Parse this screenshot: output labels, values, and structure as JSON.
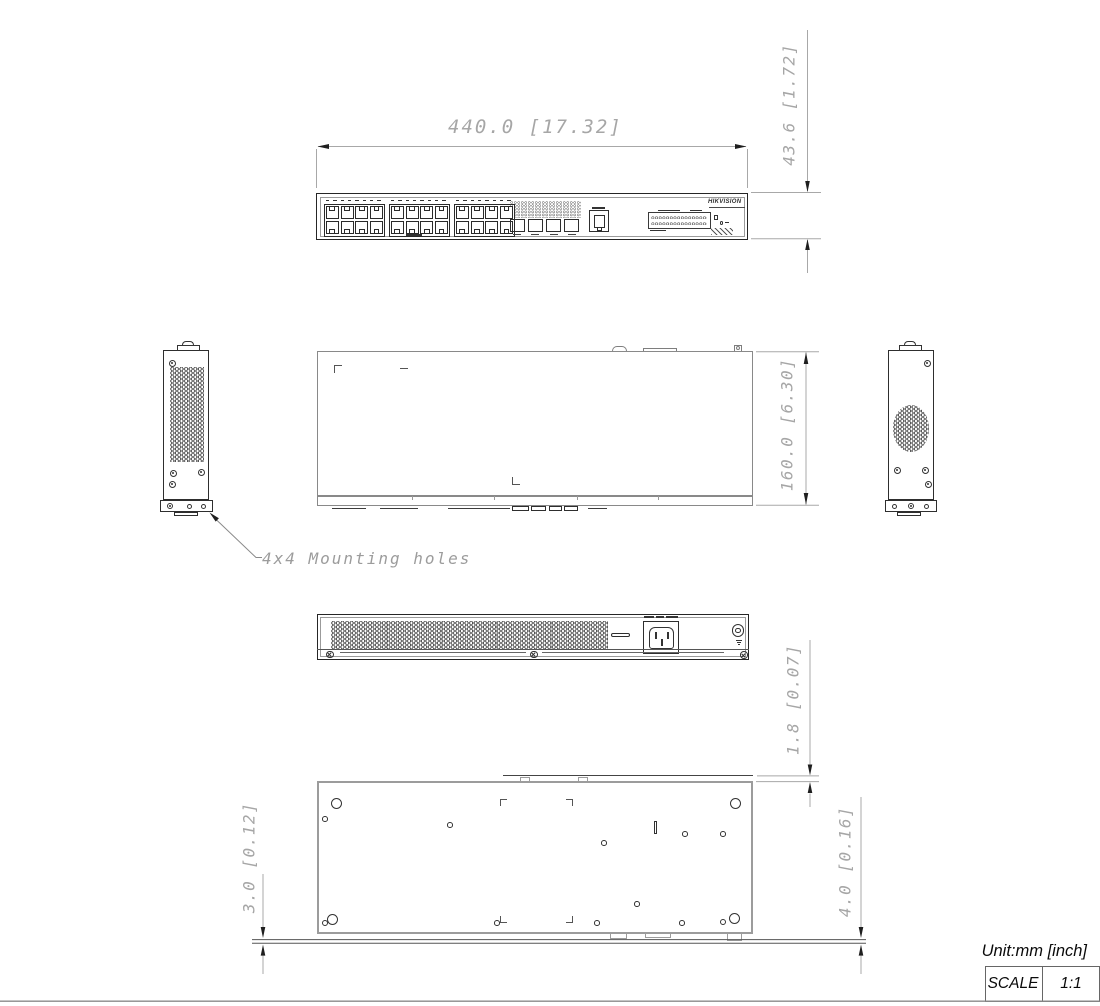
{
  "brand": "HIKVISION",
  "note": {
    "mounting": "4x4 Mounting holes"
  },
  "dims": {
    "width": "440.0 [17.32]",
    "height": "43.6 [1.72]",
    "depth": "160.0 [6.30]",
    "lip": "1.8 [0.07]",
    "bracket_offset": "3.0 [0.12]",
    "foot_height": "4.0 [0.16]"
  },
  "titleblock": {
    "unit": "Unit:mm [inch]",
    "scale_label": "SCALE",
    "scale_value": "1:1"
  },
  "counts": {
    "port_groups": 3,
    "port_group_lefts": [
      323.5,
      388.5,
      453.5
    ],
    "ports_per_group": 8,
    "label_dashes_per_group": 8,
    "sfp_slots": 4
  }
}
